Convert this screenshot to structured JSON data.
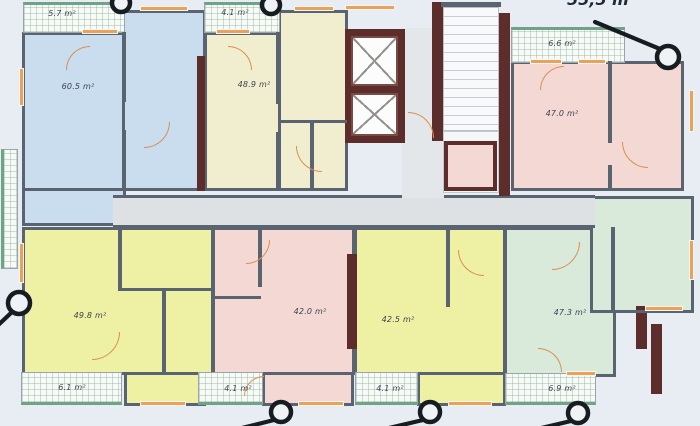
{
  "plan_title_partial": "55,5 m²",
  "apartments": [
    {
      "name": "apartment-top-left",
      "area": "60.5 m²",
      "color": "#c9ddee"
    },
    {
      "name": "apartment-top-middle",
      "area": "48.9 m²",
      "color": "#f1eecf"
    },
    {
      "name": "apartment-top-right",
      "area": "47.0 m²",
      "color": "#f4d8d4"
    },
    {
      "name": "apartment-bottom-left",
      "area": "49.8 m²",
      "color": "#eef0a4"
    },
    {
      "name": "apartment-bottom-mid-left",
      "area": "42.0 m²",
      "color": "#f4d8d4"
    },
    {
      "name": "apartment-bottom-mid-right",
      "area": "42.5 m²",
      "color": "#eef0a4"
    },
    {
      "name": "apartment-bottom-right",
      "area": "47.3 m²",
      "color": "#d9e9da"
    }
  ],
  "balconies": [
    {
      "name": "balcony-top-left",
      "area": "5.7 m²"
    },
    {
      "name": "balcony-top-middle",
      "area": "4.1 m²"
    },
    {
      "name": "balcony-top-right",
      "area": "6.6 m²"
    },
    {
      "name": "balcony-bottom-left",
      "area": "6.1 m²"
    },
    {
      "name": "balcony-bottom-mid-left",
      "area": "4.1 m²"
    },
    {
      "name": "balcony-bottom-mid-right",
      "area": "4.1 m²"
    },
    {
      "name": "balcony-bottom-right",
      "area": "6.9 m²"
    }
  ],
  "colors": {
    "background": "#e7edf2",
    "wall": "#5a6470",
    "wall_dark": "#5c2d2a",
    "corridor": "#dde1e4",
    "balcony_grid": "#80ac90",
    "window": "#e8a25c",
    "door_arc": "#d9904f",
    "marker": "#171c21",
    "label_text": "#3a4450"
  }
}
